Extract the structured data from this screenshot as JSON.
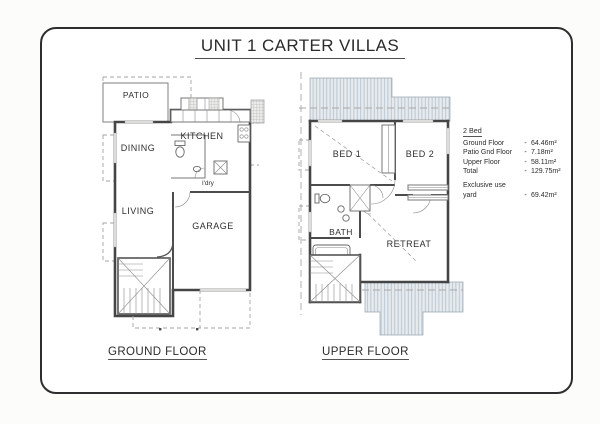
{
  "page": {
    "title": "UNIT 1 CARTER VILLAS"
  },
  "ground_floor": {
    "caption": "GROUND FLOOR",
    "rooms": {
      "patio": "PATIO",
      "dining": "DINING",
      "kitchen": "KITCHEN",
      "laundry": "l'dry",
      "living": "LIVING",
      "garage": "GARAGE"
    }
  },
  "upper_floor": {
    "caption": "UPPER FLOOR",
    "rooms": {
      "bed1": "BED 1",
      "bed2": "BED 2",
      "bath": "BATH",
      "retreat": "RETREAT"
    }
  },
  "legend": {
    "title": "2 Bed",
    "rows": [
      {
        "label": "Ground Floor",
        "sep": "-",
        "value": "64.46m²"
      },
      {
        "label": "Patio Gnd Floor",
        "sep": "-",
        "value": "7.18m²"
      },
      {
        "label": "Upper Floor",
        "sep": "-",
        "value": "58.11m²"
      },
      {
        "label": "Total",
        "sep": "-",
        "value": "129.75m²"
      }
    ],
    "exclusive": {
      "line1": "Exclusive use",
      "line2": "yard",
      "sep": "-",
      "value": "69.42m²"
    }
  },
  "colors": {
    "border": "#2e2e2e",
    "wall": "#454545",
    "thin_line": "#777777",
    "dashed_line": "#a3a3a3",
    "hatch_fill": "#e7ebee",
    "hatch_line": "#b0bec9",
    "text": "#2f2f2f"
  }
}
